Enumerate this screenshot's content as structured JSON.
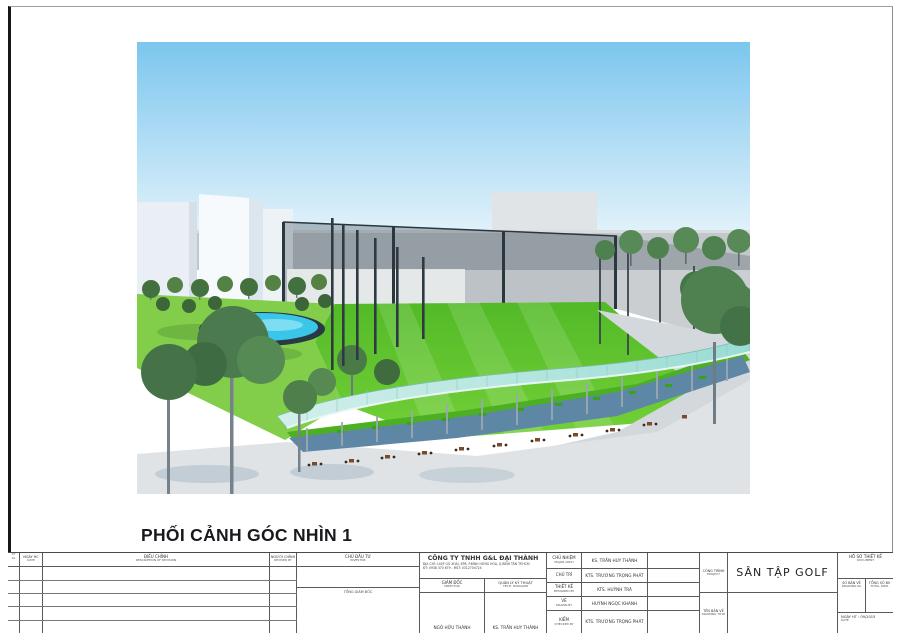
{
  "page": {
    "view_title": "PHỐI CẢNH GÓC NHÌN 1"
  },
  "colors": {
    "sky_top": "#7cc6ee",
    "sky_horizon": "#edf7fc",
    "wall_gray": "#c2c7cb",
    "field_green_dark": "#52ba27",
    "field_green_light": "#74d038",
    "lawn_green": "#82ce4a",
    "pond_water": "#39c6e9",
    "pond_rim": "#293a44",
    "canopy_light": "#d2efeb",
    "canopy_dark": "#9adcd4",
    "deck_blue": "#5e87a6",
    "pavement": "#dfe3e6",
    "tree_green": "#4e8050",
    "net_dark": "#46565f",
    "building_white": "#f7fafc"
  },
  "titleblock": {
    "rev": {
      "no_top": "ST",
      "no_bottom": "SL",
      "date": "NGÀY HC",
      "date_sub": "DATE",
      "desc": "ĐIỀU CHỈNH",
      "desc_sub": "DESCRIPTION OF REVISION",
      "by": "NGƯỜI CHỈNH",
      "by_sub": "REVISED BY"
    },
    "investor": {
      "label": "CHỦ ĐẦU TƯ",
      "sub": "INVESTOR",
      "role": "TỔNG GIÁM ĐỐC"
    },
    "company": {
      "name": "CÔNG TY TNHH G&L ĐẠI THÀNH",
      "address": "ĐỊA CHỈ: 140F GÒ XOÀI, KP6, P.BÌNH HƯNG HÒA, Q.BÌNH TÂN TP.HCM",
      "phone": "ĐT: 0938 370 679 - MST: 0312704724",
      "director_label": "GIÁM ĐỐC",
      "director_sub": "DIRECTOR",
      "director_name": "NGÔ HỮU THÀNH",
      "manager_label": "QUẢN LÝ KỸ THUẬT",
      "manager_sub": "TECH. MANAGER",
      "manager_name": "KS. TRẦN HUY THÀNH"
    },
    "staff": [
      {
        "label": "CHỦ NHIỆM",
        "sub": "MAJOR ARCH",
        "name": "KS. TRẦN HUY THÀNH"
      },
      {
        "label": "CHỦ TRÌ",
        "sub": "",
        "name": "KTS. TRƯƠNG TRỌNG PHÁT"
      },
      {
        "label": "THIẾT KẾ",
        "sub": "DESIGNED BY",
        "name": "KTS. HUỲNH TRÃ"
      },
      {
        "label": "VẼ",
        "sub": "DRAWN BY",
        "name": "HUỲNH NGỌC KHANH"
      },
      {
        "label": "KIỂM",
        "sub": "CHECKED BY",
        "name": "KTS. TRƯƠNG TRỌNG PHÁT"
      }
    ],
    "project": {
      "label": "CÔNG TRÌNH",
      "sub": "PROJECT",
      "name": "SÂN TẬP GOLF"
    },
    "drawing_title": {
      "label": "TÊN BẢN VẼ",
      "sub": "DRAWING TITLE",
      "value": ""
    },
    "document": {
      "label": "HỒ SƠ THIẾT KẾ",
      "sub": "DOCUMENT"
    },
    "drawing_no": {
      "label": "SỐ BẢN VẼ",
      "sub": "DRAWING No",
      "value": ""
    },
    "total_drawings": {
      "label": "TỔNG SỐ BV",
      "sub": "TOTAL DRW.",
      "value": ""
    },
    "finish_date": {
      "label": "NGÀY HT : 09/2015",
      "sub": "DATE"
    }
  }
}
